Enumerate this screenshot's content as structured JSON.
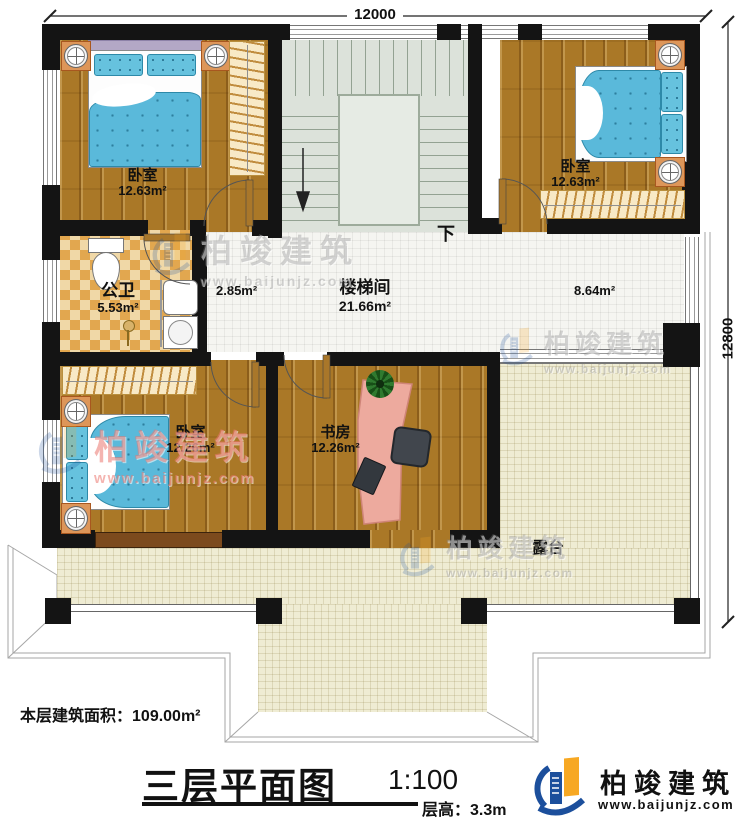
{
  "dimensions": {
    "top": "12000",
    "right": "12800"
  },
  "rooms": {
    "bedroom_tl": {
      "name": "卧室",
      "area": "12.63m²"
    },
    "bedroom_tr": {
      "name": "卧室",
      "area": "12.63m²"
    },
    "bathroom": {
      "name": "公卫",
      "area": "5.53m²"
    },
    "stair_hall": {
      "name": "楼梯间",
      "area": "21.66m²",
      "landing_area": "2.85m²",
      "corridor_area": "8.64m²",
      "down": "下"
    },
    "bedroom_bl": {
      "name": "卧室",
      "area": "12.26m²"
    },
    "study": {
      "name": "书房",
      "area": "12.26m²"
    },
    "terrace": {
      "name": "露台"
    }
  },
  "footer": {
    "floor_area_label": "本层建筑面积：",
    "floor_area_value": "109.00m²",
    "title": "三层平面图",
    "scale": "1:100",
    "floor_height_label": "层高：",
    "floor_height_value": "3.3m"
  },
  "branding": {
    "company": "柏竣建筑",
    "website": "www.baijunjz.com"
  },
  "colors": {
    "wall": "#141414",
    "wood_floor": "#aa7827",
    "hall_tile": "#f5f5f1",
    "terrace_tile": "#efecd3",
    "stairs": "#dce2da",
    "bathroom_checker": "#e2a74f",
    "bed_blue": "#5ab9da",
    "desk_salmon": "#edaa9e",
    "brand_blue": "#1c4f9c",
    "brand_orange": "#f7a823"
  }
}
